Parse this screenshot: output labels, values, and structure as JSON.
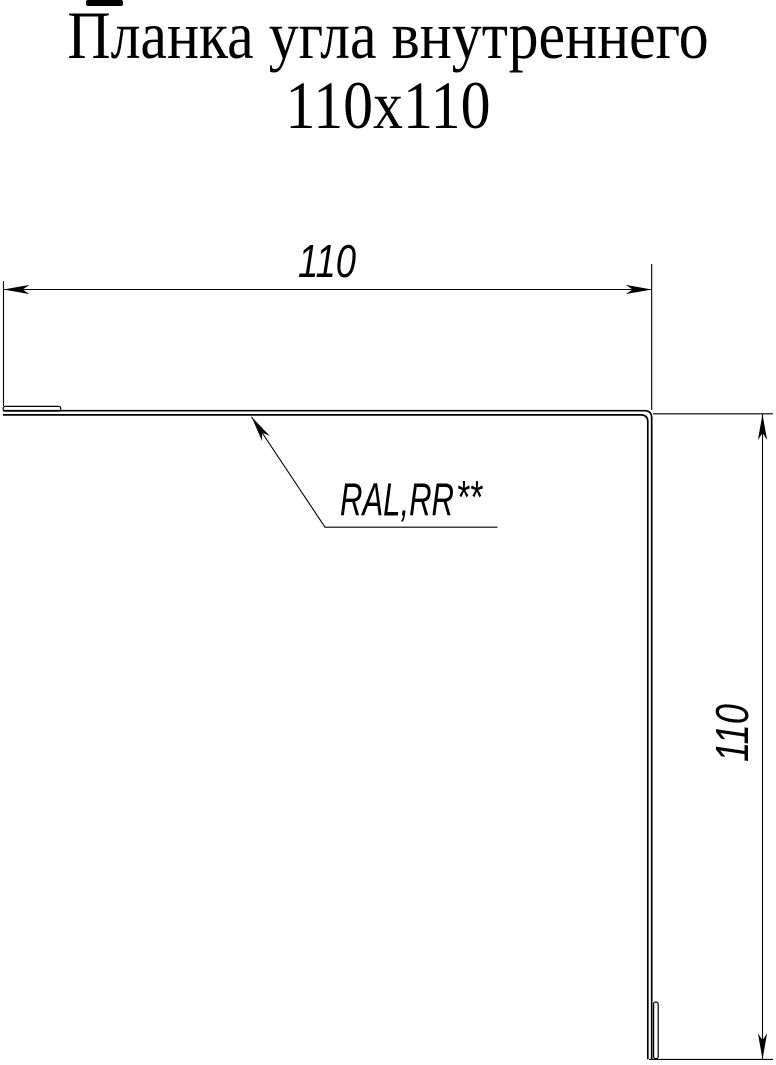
{
  "title": {
    "line1": "Планка угла внутреннего",
    "line2": "110х110"
  },
  "drawing": {
    "type": "technical-drawing",
    "subject": "inside-corner flashing profile (L-shape section)",
    "dimensions": {
      "horizontal": {
        "value": "110"
      },
      "vertical": {
        "value": "110"
      }
    },
    "leader": {
      "text": "RAL,RR",
      "superscript": "**"
    },
    "colors": {
      "line": "#000000",
      "background": "#ffffff"
    }
  }
}
